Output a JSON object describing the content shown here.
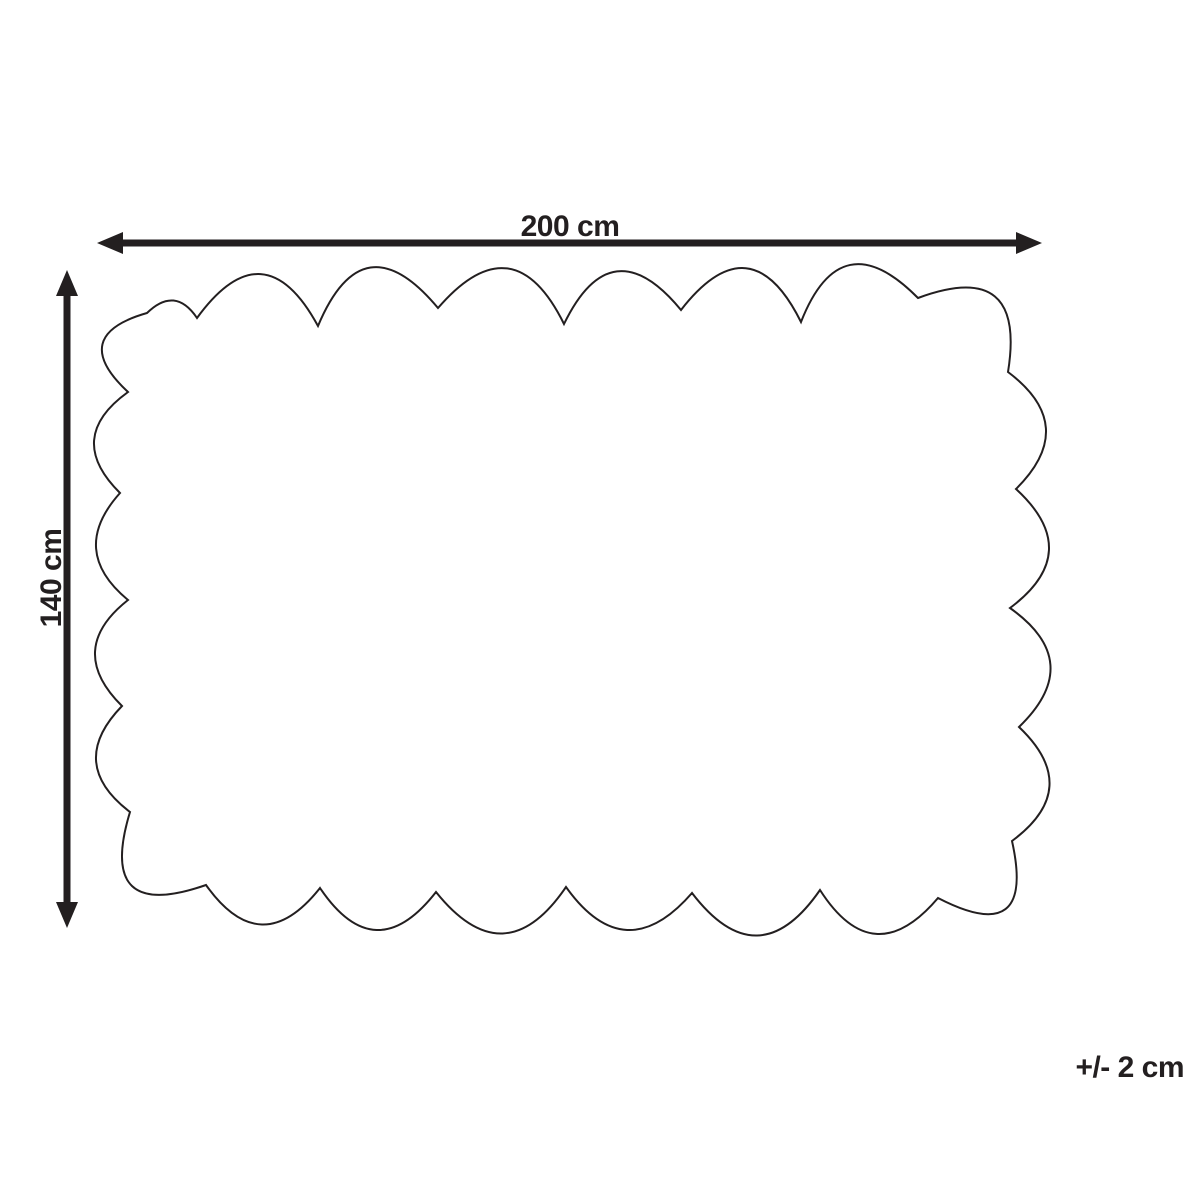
{
  "diagram": {
    "width_label": "200 cm",
    "height_label": "140 cm",
    "tolerance_label": "+/- 2 cm",
    "ink_color": "#231f20",
    "background_color": "#ffffff",
    "outline_shape": "scalloped-rectangle"
  }
}
